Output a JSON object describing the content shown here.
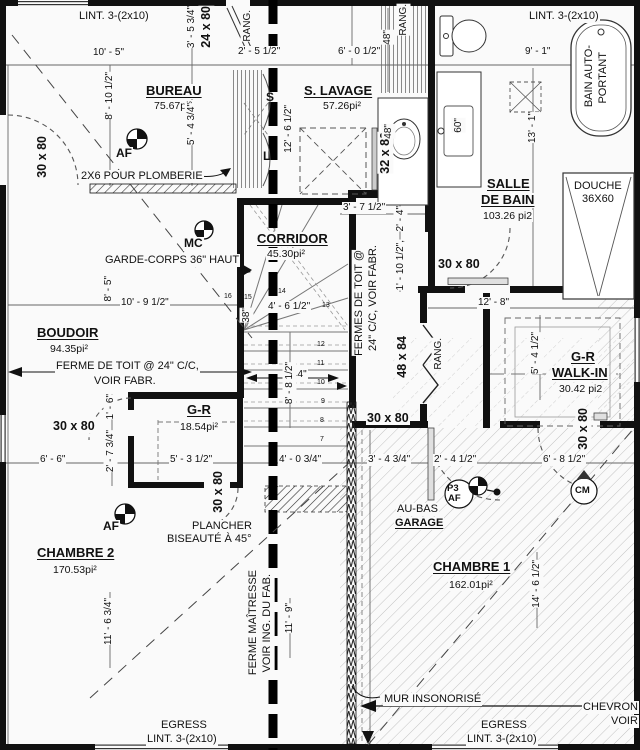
{
  "rooms": [
    {
      "name": "BUREAU",
      "area": "75.67pi²"
    },
    {
      "name": "S. LAVAGE",
      "area": "57.26pi²"
    },
    {
      "name_l1": "SALLE",
      "name_l2": "DE BAIN",
      "area": "103.26 pi2"
    },
    {
      "name": "CORRIDOR",
      "area": "45.30pi²"
    },
    {
      "name": "BOUDOIR",
      "area": "94.35pi²"
    },
    {
      "name": "G-R",
      "area": "18.54pi²"
    },
    {
      "name_l1": "G-R",
      "name_l2": "WALK-IN",
      "area": "30.42 pi2"
    },
    {
      "name": "CHAMBRE 2",
      "area": "170.53pi²"
    },
    {
      "name": "CHAMBRE 1",
      "area": "162.01pi²"
    }
  ],
  "doors": [
    {
      "label": "24 x 80"
    },
    {
      "label": "30 x 80"
    },
    {
      "label": "32 x 80"
    },
    {
      "label": "30 x 80"
    },
    {
      "label": "48 x 84"
    },
    {
      "label": "30 x 80"
    },
    {
      "label": "30 x 80"
    },
    {
      "label": "30 x 80"
    },
    {
      "label": "30 x 80"
    }
  ],
  "dims": [
    "10' - 5\"",
    "3' - 5 3/4\"",
    "2' - 5 1/2\"",
    "6' - 0 1/2\"",
    "9' - 1\"",
    "8' - 10 1/2\"",
    "5' - 4 3/4\"",
    "12' - 6 1/2\"",
    "48\"",
    "48\"",
    "60\"",
    "13' - 1\"",
    "3' - 7 1/2\"",
    "2' - 4\"",
    "1' - 10 1/2\",",
    "8' - 5\"",
    "10' - 9 1/2\"",
    "4' - 6 1/2\"",
    "38\"",
    "44\"",
    "8' - 8 1/2\"",
    "12' - 8\"",
    "5' - 4 1/2\"",
    "1' - 6\"",
    "2' - 7 3/4\"",
    "6' - 6\"",
    "5' - 3 1/2\"",
    "4' - 0 3/4\"",
    "3' - 4 3/4\"",
    "2' - 4 1/2\"",
    "6' - 8 1/2\"",
    "14' - 6 1/2\"",
    "11' - 9\"",
    "11' - 6 3/4\""
  ],
  "notes": [
    {
      "lines": [
        "LINT. 3-(2x10)"
      ]
    },
    {
      "lines": [
        "LINT. 3-(2x10)"
      ]
    },
    {
      "lines": [
        "2X6 POUR PLOMBERIE"
      ]
    },
    {
      "lines": [
        "GARDE-CORPS 36\" HAUT"
      ]
    },
    {
      "lines": [
        "FERME DE TOIT @ 24\" C/C,",
        "VOIR FABR."
      ]
    },
    {
      "lines": [
        "FERMES DE TOIT @",
        "24\" C/C, VOIR FABR."
      ]
    },
    {
      "lines": [
        "PLANCHER",
        "BISEAUTÉ À 45°"
      ]
    },
    {
      "lines": [
        "AU-BAS",
        "GARAGE"
      ]
    },
    {
      "lines": [
        "FERME MAÎTRESSE",
        "VOIR ING. DU FAB."
      ]
    },
    {
      "lines": [
        "MUR INSONORISÉ"
      ]
    },
    {
      "lines": [
        "EGRESS",
        "LINT. 3-(2x10)"
      ]
    },
    {
      "lines": [
        "EGRESS",
        "LINT. 3-(2x10)"
      ]
    },
    {
      "lines": [
        "CHEVRON",
        "VOIR"
      ]
    },
    {
      "lines": [
        "BAIN AUTO-",
        "PORTANT"
      ]
    },
    {
      "lines": [
        "DOUCHE",
        "36X60"
      ]
    }
  ],
  "misc": {
    "rang": "RANG.",
    "s": "S",
    "l": "L"
  },
  "markers": {
    "af": "AF",
    "mc": "MC",
    "p3": "P3",
    "cm": "CM"
  },
  "stairs": {
    "numbers": [
      "7",
      "8",
      "9",
      "10",
      "11",
      "12",
      "13",
      "14",
      "15",
      "16"
    ]
  },
  "colors": {
    "ink": "#111111",
    "hatch": "#b9b9b9",
    "paper": "#fafafa"
  }
}
